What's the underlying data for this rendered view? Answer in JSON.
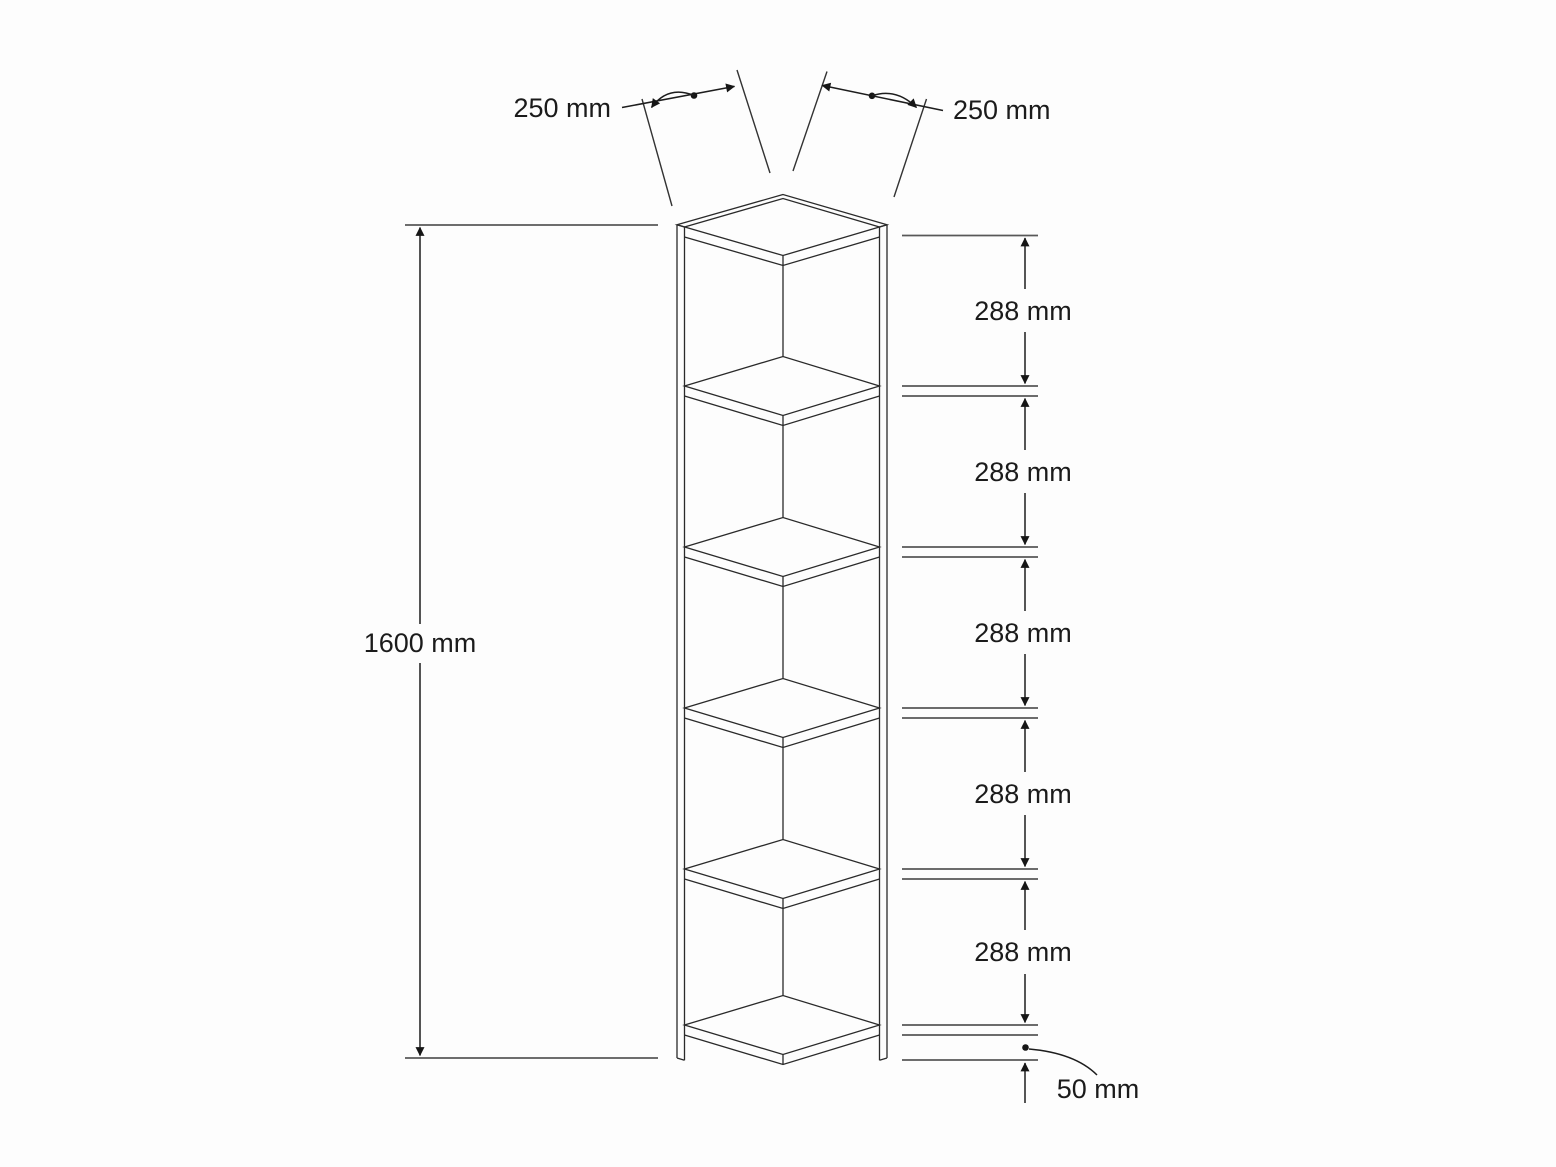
{
  "figure": {
    "kind": "technical dimension drawing",
    "object": "corner shelf unit",
    "view": "isometric",
    "units": "mm",
    "shelf_boards_visible": 6
  },
  "dims": {
    "height": {
      "label": "1600 mm",
      "value": 1600
    },
    "top_left": {
      "label": "250 mm",
      "value": 250
    },
    "top_right": {
      "label": "250 mm",
      "value": 250
    },
    "spacings": [
      {
        "label": "288 mm",
        "value": 288
      },
      {
        "label": "288 mm",
        "value": 288
      },
      {
        "label": "288 mm",
        "value": 288
      },
      {
        "label": "288 mm",
        "value": 288
      },
      {
        "label": "288 mm",
        "value": 288
      }
    ],
    "bottom_clearance": {
      "label": "50 mm",
      "value": 50
    }
  },
  "colors": {
    "background": "#fdfdfd",
    "outline": "#2a2a2a",
    "extension_lines": "#585858",
    "dimension_lines": "#1d1d1d",
    "text": "#1b1b1b"
  }
}
